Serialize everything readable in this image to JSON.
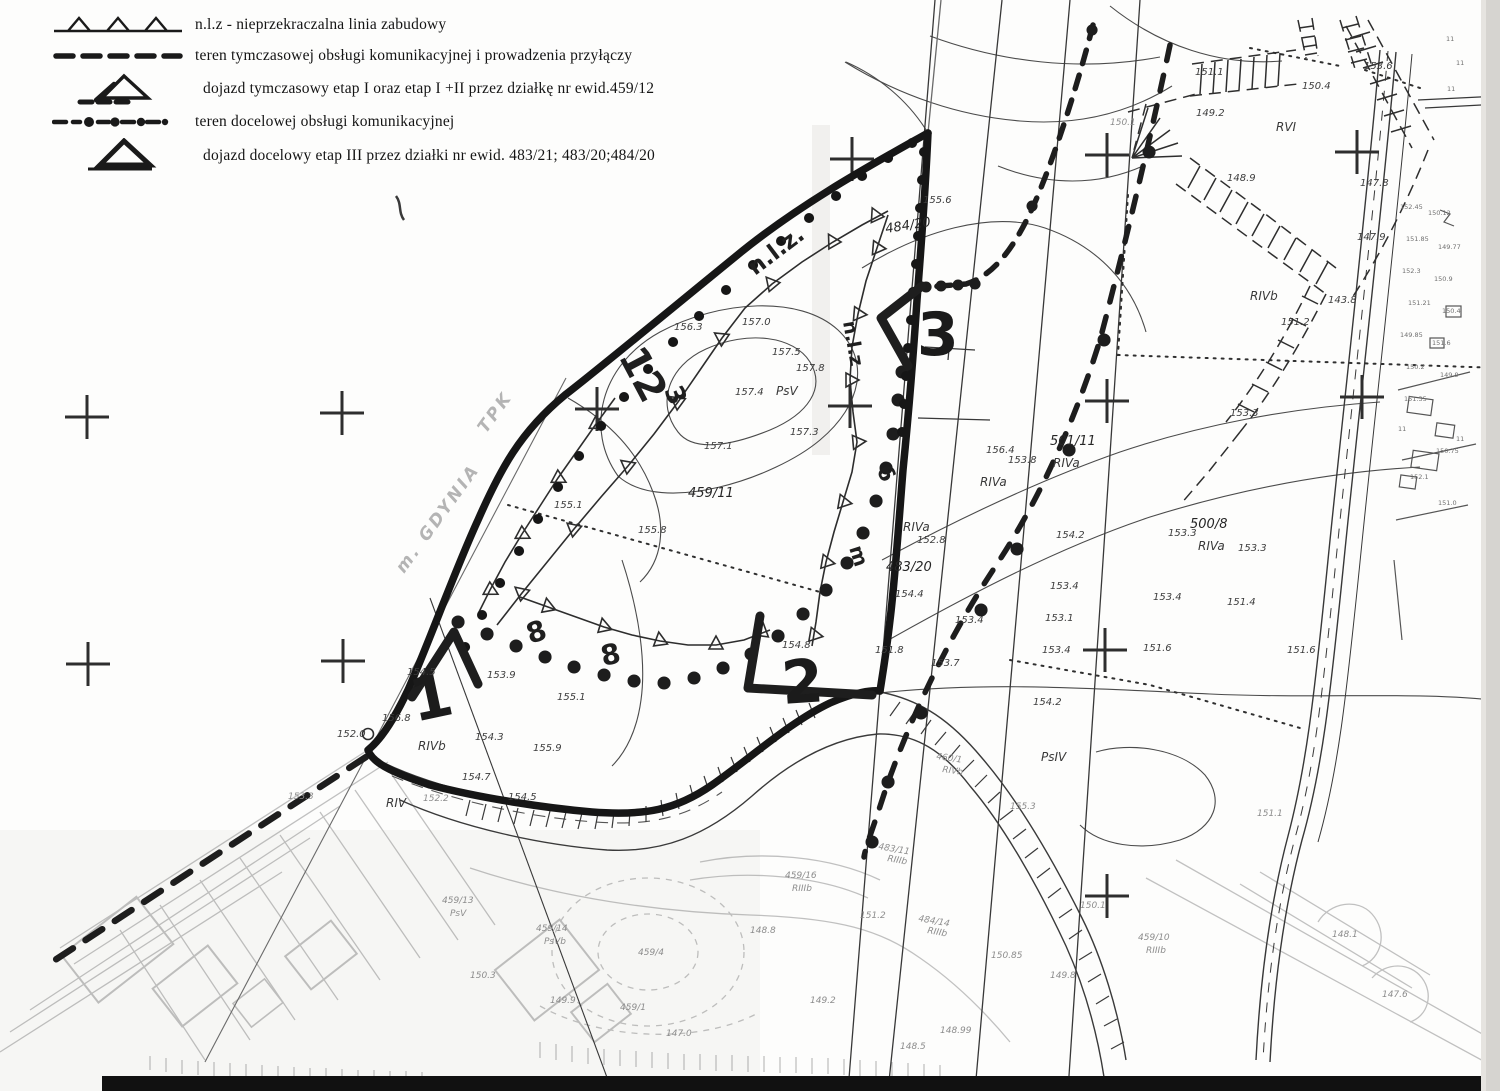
{
  "legend": {
    "items": [
      {
        "id": "nlz",
        "text": "n.l.z -  nieprzekraczalna linia zabudowy"
      },
      {
        "id": "teren-tymczasowej",
        "text": "teren tymczasowej obsługi  komunikacyjnej i prowadzenia przyłączy"
      },
      {
        "id": "dojazd-tymczasowy",
        "text": "dojazd  tymczasowy    etap I oraz  etap I +II   przez działkę nr ewid.459/12"
      },
      {
        "id": "teren-docelowej",
        "text": "teren docelowej obsługi  komunikacyjnej"
      },
      {
        "id": "dojazd-docelowy",
        "text": "dojazd  docelowy etap III przez działki nr ewid. 483/21; 483/20;484/20"
      }
    ]
  },
  "colors": {
    "ink": "#1a1a1a",
    "mid_gray": "#4b4b4b",
    "faint_gray": "#8d8d8d",
    "paper": "#fdfdfc"
  },
  "map_labels": [
    {
      "t": "1",
      "x": 415,
      "y": 722,
      "r": -12,
      "c": "hand-big"
    },
    {
      "t": "2",
      "x": 783,
      "y": 704,
      "r": -4,
      "c": "hand-big"
    },
    {
      "t": "3",
      "x": 917,
      "y": 355,
      "c": "hand-big"
    },
    {
      "t": "12",
      "x": 618,
      "y": 356,
      "r": 62,
      "s": 40,
      "c": "hand"
    },
    {
      "t": "3",
      "x": 664,
      "y": 390,
      "r": 68,
      "s": 26,
      "c": "hand"
    },
    {
      "t": "n.l.z.",
      "x": 755,
      "y": 276,
      "r": -37,
      "s": 23,
      "c": "hand"
    },
    {
      "t": "n.l.z",
      "x": 843,
      "y": 322,
      "r": 80,
      "s": 19,
      "c": "hand"
    },
    {
      "t": "6",
      "x": 876,
      "y": 470,
      "r": 62,
      "s": 22,
      "c": "hand"
    },
    {
      "t": "m",
      "x": 849,
      "y": 548,
      "r": 72,
      "s": 20,
      "c": "hand"
    },
    {
      "t": "8",
      "x": 530,
      "y": 644,
      "r": -18,
      "s": 28,
      "c": "hand"
    },
    {
      "t": "8",
      "x": 603,
      "y": 666,
      "r": -12,
      "s": 28,
      "c": "hand"
    },
    {
      "t": "m. GDYNIA",
      "x": 404,
      "y": 574,
      "r": -54,
      "c": "handfaint"
    },
    {
      "t": "TPK",
      "x": 486,
      "y": 434,
      "r": -54,
      "c": "handfaint"
    },
    {
      "t": "459/11",
      "x": 688,
      "y": 497,
      "c": "parcel"
    },
    {
      "t": "484/20",
      "x": 886,
      "y": 233,
      "r": -9,
      "c": "parcel"
    },
    {
      "t": "483/20",
      "x": 886,
      "y": 571,
      "c": "parcel"
    },
    {
      "t": "501/11",
      "x": 1050,
      "y": 445,
      "c": "parcel"
    },
    {
      "t": "500/8",
      "x": 1190,
      "y": 528,
      "c": "parcel"
    },
    {
      "t": "PsV",
      "x": 776,
      "y": 395,
      "c": "soil"
    },
    {
      "t": "RIVb",
      "x": 418,
      "y": 750,
      "c": "soil"
    },
    {
      "t": "RIVa",
      "x": 903,
      "y": 531,
      "c": "soil"
    },
    {
      "t": "RIVa",
      "x": 980,
      "y": 486,
      "c": "soil"
    },
    {
      "t": "RIVa",
      "x": 1053,
      "y": 467,
      "c": "soil"
    },
    {
      "t": "RIVa",
      "x": 1198,
      "y": 550,
      "c": "soil"
    },
    {
      "t": "RVI",
      "x": 1276,
      "y": 131,
      "c": "soil"
    },
    {
      "t": "RIVb",
      "x": 1250,
      "y": 300,
      "c": "soil"
    },
    {
      "t": "PsIV",
      "x": 1041,
      "y": 761,
      "c": "soil"
    },
    {
      "t": "RIV",
      "x": 386,
      "y": 807,
      "c": "soil"
    },
    {
      "t": "155.6",
      "x": 923,
      "y": 203
    },
    {
      "t": "157.0",
      "x": 742,
      "y": 325
    },
    {
      "t": "157.5",
      "x": 772,
      "y": 355
    },
    {
      "t": "157.8",
      "x": 796,
      "y": 371
    },
    {
      "t": "157.4",
      "x": 735,
      "y": 395
    },
    {
      "t": "157.3",
      "x": 790,
      "y": 435
    },
    {
      "t": "157.1",
      "x": 704,
      "y": 449
    },
    {
      "t": "156.3",
      "x": 674,
      "y": 330
    },
    {
      "t": "155.1",
      "x": 554,
      "y": 508
    },
    {
      "t": "155.8",
      "x": 638,
      "y": 533
    },
    {
      "t": "153.9",
      "x": 487,
      "y": 678
    },
    {
      "t": "155.1",
      "x": 557,
      "y": 700
    },
    {
      "t": "154.8",
      "x": 782,
      "y": 648
    },
    {
      "t": "154.5",
      "x": 407,
      "y": 675
    },
    {
      "t": "156.8",
      "x": 382,
      "y": 721
    },
    {
      "t": "154.3",
      "x": 475,
      "y": 740
    },
    {
      "t": "154.7",
      "x": 462,
      "y": 780
    },
    {
      "t": "155.9",
      "x": 533,
      "y": 751
    },
    {
      "t": "154.5",
      "x": 508,
      "y": 800
    },
    {
      "t": "152.0",
      "x": 337,
      "y": 737
    },
    {
      "t": "156.4",
      "x": 986,
      "y": 453
    },
    {
      "t": "153.8",
      "x": 1008,
      "y": 463
    },
    {
      "t": "152.8",
      "x": 917,
      "y": 543
    },
    {
      "t": "154.4",
      "x": 895,
      "y": 597
    },
    {
      "t": "151.8",
      "x": 875,
      "y": 653
    },
    {
      "t": "153.7",
      "x": 931,
      "y": 666
    },
    {
      "t": "153.4",
      "x": 955,
      "y": 623
    },
    {
      "t": "154.2",
      "x": 1056,
      "y": 538
    },
    {
      "t": "153.4",
      "x": 1050,
      "y": 589
    },
    {
      "t": "153.1",
      "x": 1045,
      "y": 621
    },
    {
      "t": "153.4",
      "x": 1042,
      "y": 653
    },
    {
      "t": "153.3",
      "x": 1168,
      "y": 536
    },
    {
      "t": "153.3",
      "x": 1238,
      "y": 551
    },
    {
      "t": "153.3",
      "x": 1230,
      "y": 416
    },
    {
      "t": "153.4",
      "x": 1153,
      "y": 600
    },
    {
      "t": "151.4",
      "x": 1227,
      "y": 605
    },
    {
      "t": "151.6",
      "x": 1143,
      "y": 651
    },
    {
      "t": "151.6",
      "x": 1287,
      "y": 653
    },
    {
      "t": "154.2",
      "x": 1033,
      "y": 705
    },
    {
      "t": "151.1",
      "x": 1195,
      "y": 75
    },
    {
      "t": "150.4",
      "x": 1302,
      "y": 89
    },
    {
      "t": "149.2",
      "x": 1196,
      "y": 116
    },
    {
      "t": "153.6",
      "x": 1364,
      "y": 69
    },
    {
      "t": "148.9",
      "x": 1227,
      "y": 181
    },
    {
      "t": "147.8",
      "x": 1360,
      "y": 186
    },
    {
      "t": "147.9",
      "x": 1357,
      "y": 240
    },
    {
      "t": "143.8",
      "x": 1328,
      "y": 303
    },
    {
      "t": "151.2",
      "x": 1281,
      "y": 325
    },
    {
      "t": "150.1",
      "x": 1110,
      "y": 125,
      "c": "faint"
    },
    {
      "t": "155.3",
      "x": 1010,
      "y": 809,
      "c": "faint"
    },
    {
      "t": "460/1",
      "x": 936,
      "y": 759,
      "r": 8,
      "c": "faint"
    },
    {
      "t": "RIVb",
      "x": 942,
      "y": 772,
      "r": 8,
      "c": "faint"
    },
    {
      "t": "483/11",
      "x": 878,
      "y": 849,
      "r": 10,
      "c": "faint"
    },
    {
      "t": "RIIIb",
      "x": 887,
      "y": 861,
      "r": 10,
      "c": "faint"
    },
    {
      "t": "484/14",
      "x": 918,
      "y": 921,
      "r": 10,
      "c": "faint"
    },
    {
      "t": "RIIIb",
      "x": 927,
      "y": 933,
      "r": 10,
      "c": "faint"
    },
    {
      "t": "459/16",
      "x": 785,
      "y": 878,
      "c": "faint"
    },
    {
      "t": "RIIIb",
      "x": 792,
      "y": 891,
      "c": "faint"
    },
    {
      "t": "459/13",
      "x": 442,
      "y": 903,
      "c": "faint"
    },
    {
      "t": "PsV",
      "x": 450,
      "y": 916,
      "c": "faint"
    },
    {
      "t": "459/14",
      "x": 536,
      "y": 931,
      "c": "faint"
    },
    {
      "t": "PsVb",
      "x": 544,
      "y": 944,
      "c": "faint"
    },
    {
      "t": "459/4",
      "x": 638,
      "y": 955,
      "c": "faint"
    },
    {
      "t": "459/1",
      "x": 620,
      "y": 1010,
      "c": "faint"
    },
    {
      "t": "459/10",
      "x": 1138,
      "y": 940,
      "c": "faint"
    },
    {
      "t": "RIIIb",
      "x": 1146,
      "y": 953,
      "c": "faint"
    },
    {
      "t": "151.1",
      "x": 1257,
      "y": 816,
      "c": "faint"
    },
    {
      "t": "150.85",
      "x": 991,
      "y": 958,
      "c": "faint"
    },
    {
      "t": "148.99",
      "x": 940,
      "y": 1033,
      "c": "faint"
    },
    {
      "t": "149.8",
      "x": 1050,
      "y": 978,
      "c": "faint"
    },
    {
      "t": "150.1",
      "x": 1080,
      "y": 908,
      "c": "faint"
    },
    {
      "t": "151.2",
      "x": 860,
      "y": 918,
      "c": "faint"
    },
    {
      "t": "148.8",
      "x": 750,
      "y": 933,
      "c": "faint"
    },
    {
      "t": "149.9",
      "x": 550,
      "y": 1003,
      "c": "faint"
    },
    {
      "t": "150.3",
      "x": 470,
      "y": 978,
      "c": "faint"
    },
    {
      "t": "149.2",
      "x": 810,
      "y": 1003,
      "c": "faint"
    },
    {
      "t": "148.5",
      "x": 900,
      "y": 1049,
      "c": "faint"
    },
    {
      "t": "153.3",
      "x": 288,
      "y": 799,
      "c": "faint"
    },
    {
      "t": "152.2",
      "x": 423,
      "y": 801,
      "c": "faint"
    },
    {
      "t": "148.1",
      "x": 1332,
      "y": 937,
      "c": "faint"
    },
    {
      "t": "147.6",
      "x": 1382,
      "y": 997,
      "c": "faint"
    },
    {
      "t": "147.0",
      "x": 666,
      "y": 1036,
      "c": "faint"
    },
    {
      "t": "152.45",
      "x": 1400,
      "y": 209,
      "c": "tiny"
    },
    {
      "t": "150.12",
      "x": 1428,
      "y": 215,
      "c": "tiny"
    },
    {
      "t": "151.85",
      "x": 1406,
      "y": 241,
      "c": "tiny"
    },
    {
      "t": "149.77",
      "x": 1438,
      "y": 249,
      "c": "tiny"
    },
    {
      "t": "152.3",
      "x": 1402,
      "y": 273,
      "c": "tiny"
    },
    {
      "t": "150.9",
      "x": 1434,
      "y": 281,
      "c": "tiny"
    },
    {
      "t": "151.21",
      "x": 1408,
      "y": 305,
      "c": "tiny"
    },
    {
      "t": "150.4",
      "x": 1442,
      "y": 313,
      "c": "tiny"
    },
    {
      "t": "149.85",
      "x": 1400,
      "y": 337,
      "c": "tiny"
    },
    {
      "t": "151.6",
      "x": 1432,
      "y": 345,
      "c": "tiny"
    },
    {
      "t": "150.2",
      "x": 1406,
      "y": 369,
      "c": "tiny"
    },
    {
      "t": "149.9",
      "x": 1440,
      "y": 377,
      "c": "tiny"
    },
    {
      "t": "151.35",
      "x": 1404,
      "y": 401,
      "c": "tiny"
    },
    {
      "t": "150.75",
      "x": 1436,
      "y": 453,
      "c": "tiny"
    },
    {
      "t": "152.1",
      "x": 1410,
      "y": 479,
      "c": "tiny"
    },
    {
      "t": "151.0",
      "x": 1438,
      "y": 505,
      "c": "tiny"
    },
    {
      "t": "11",
      "x": 1446,
      "y": 41,
      "c": "tiny"
    },
    {
      "t": "11",
      "x": 1456,
      "y": 65,
      "c": "tiny"
    },
    {
      "t": "11",
      "x": 1447,
      "y": 91,
      "c": "tiny"
    },
    {
      "t": "11",
      "x": 1456,
      "y": 441,
      "c": "tiny"
    },
    {
      "t": "11",
      "x": 1398,
      "y": 431,
      "c": "tiny"
    }
  ]
}
